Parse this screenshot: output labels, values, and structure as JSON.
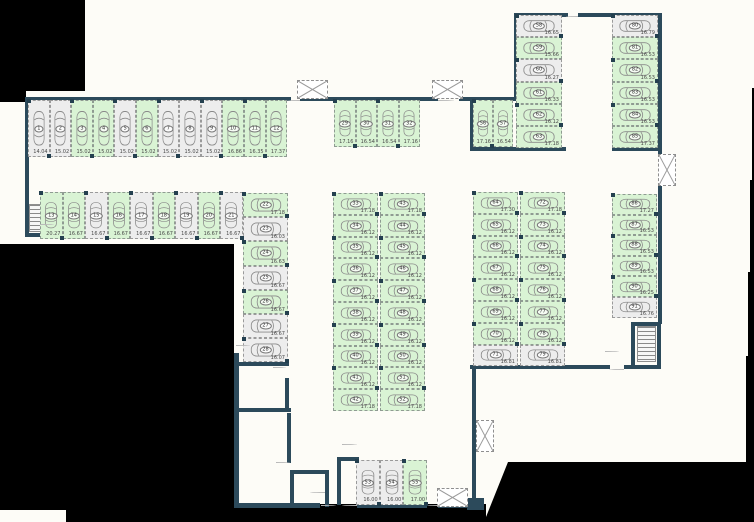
{
  "title": "parking-level-floor-plan",
  "colors": {
    "wall": "#2c4a5b",
    "stall_available": "#d9f3d4",
    "stall_unavailable": "#ededed",
    "background": "#fdfcf7",
    "dashed_line": "#8f9b92",
    "masked": "#000000"
  },
  "groups": [
    {
      "name": "row-top",
      "orient": "v",
      "x": 28,
      "y": 100,
      "w": 21.6,
      "h": 57,
      "stalls": [
        {
          "n": "1",
          "m": "14.04",
          "a": false
        },
        {
          "n": "2",
          "m": "15.02",
          "a": false
        },
        {
          "n": "3",
          "m": "15.02",
          "a": true
        },
        {
          "n": "4",
          "m": "15.02",
          "a": true
        },
        {
          "n": "5",
          "m": "15.02",
          "a": false
        },
        {
          "n": "6",
          "m": "15.02",
          "a": true
        },
        {
          "n": "7",
          "m": "15.02",
          "a": false
        },
        {
          "n": "8",
          "m": "15.02",
          "a": false
        },
        {
          "n": "9",
          "m": "15.02",
          "a": false
        },
        {
          "n": "10",
          "m": "16.86",
          "a": true
        },
        {
          "n": "11",
          "m": "16.35",
          "a": true
        },
        {
          "n": "12",
          "m": "17.37",
          "a": true
        }
      ]
    },
    {
      "name": "row-second",
      "orient": "v",
      "x": 40,
      "y": 192,
      "w": 22.5,
      "h": 47,
      "stalls": [
        {
          "n": "13",
          "m": "20.27",
          "a": true
        },
        {
          "n": "14",
          "m": "16.67",
          "a": true
        },
        {
          "n": "15",
          "m": "16.67",
          "a": false
        },
        {
          "n": "16",
          "m": "16.67",
          "a": true
        },
        {
          "n": "17",
          "m": "16.67",
          "a": false
        },
        {
          "n": "18",
          "m": "16.67",
          "a": true
        },
        {
          "n": "19",
          "m": "16.67",
          "a": false
        },
        {
          "n": "20",
          "m": "16.67",
          "a": true
        },
        {
          "n": "21",
          "m": "16.67",
          "a": false
        }
      ]
    },
    {
      "name": "col-left",
      "orient": "h",
      "x": 243,
      "y": 193,
      "w": 45,
      "h": 24.2,
      "stalls": [
        {
          "n": "22",
          "m": "17.18",
          "a": true
        },
        {
          "n": "23",
          "m": "16.03",
          "a": false
        },
        {
          "n": "24",
          "m": "16.63",
          "a": true
        },
        {
          "n": "25",
          "m": "16.67",
          "a": false
        },
        {
          "n": "26",
          "m": "16.67",
          "a": true
        },
        {
          "n": "27",
          "m": "16.67",
          "a": false
        },
        {
          "n": "28",
          "m": "16.07",
          "a": false
        }
      ]
    },
    {
      "name": "mid-top-row",
      "orient": "v",
      "x": 334,
      "y": 100,
      "w": 21.5,
      "h": 47,
      "stalls": [
        {
          "n": "29",
          "m": "17.16",
          "a": true
        },
        {
          "n": "30",
          "m": "16.54",
          "a": true
        },
        {
          "n": "31",
          "m": "16.54",
          "a": true
        },
        {
          "n": "32",
          "m": "17.16",
          "a": true
        }
      ]
    },
    {
      "name": "mid-block-left",
      "orient": "h",
      "x": 333,
      "y": 193,
      "w": 45,
      "h": 21.8,
      "stalls": [
        {
          "n": "33",
          "m": "17.18",
          "a": true
        },
        {
          "n": "34",
          "m": "16.12",
          "a": true
        },
        {
          "n": "35",
          "m": "16.12",
          "a": true
        },
        {
          "n": "36",
          "m": "16.12",
          "a": true
        },
        {
          "n": "37",
          "m": "16.12",
          "a": true
        },
        {
          "n": "38",
          "m": "16.12",
          "a": true
        },
        {
          "n": "39",
          "m": "16.12",
          "a": true
        },
        {
          "n": "40",
          "m": "16.12",
          "a": true
        },
        {
          "n": "41",
          "m": "16.12",
          "a": true
        },
        {
          "n": "42",
          "m": "17.18",
          "a": true
        }
      ]
    },
    {
      "name": "mid-block-right",
      "orient": "h",
      "x": 380,
      "y": 193,
      "w": 45,
      "h": 21.8,
      "stalls": [
        {
          "n": "43",
          "m": "17.18",
          "a": true
        },
        {
          "n": "44",
          "m": "16.12",
          "a": true
        },
        {
          "n": "45",
          "m": "16.12",
          "a": true
        },
        {
          "n": "46",
          "m": "16.12",
          "a": true
        },
        {
          "n": "47",
          "m": "16.12",
          "a": true
        },
        {
          "n": "48",
          "m": "16.12",
          "a": true
        },
        {
          "n": "49",
          "m": "16.12",
          "a": true
        },
        {
          "n": "50",
          "m": "16.12",
          "a": true
        },
        {
          "n": "51",
          "m": "16.12",
          "a": true
        },
        {
          "n": "52",
          "m": "17.18",
          "a": true
        }
      ]
    },
    {
      "name": "bottom-row",
      "orient": "v",
      "x": 356,
      "y": 460,
      "w": 23.7,
      "h": 45,
      "stalls": [
        {
          "n": "53",
          "m": "16.00",
          "a": false
        },
        {
          "n": "54",
          "m": "16.00",
          "a": false
        },
        {
          "n": "55",
          "m": "17.00",
          "a": true
        }
      ]
    },
    {
      "name": "topright-vertical-pair",
      "orient": "v",
      "x": 473,
      "y": 100,
      "w": 20,
      "h": 47,
      "stalls": [
        {
          "n": "56",
          "m": "17.16",
          "a": true
        },
        {
          "n": "57",
          "m": "16.54",
          "a": true
        }
      ]
    },
    {
      "name": "topright-col-left",
      "orient": "h",
      "x": 516,
      "y": 15,
      "w": 46,
      "h": 22.2,
      "stalls": [
        {
          "n": "58",
          "m": "16.65",
          "a": false
        },
        {
          "n": "59",
          "m": "15.66",
          "a": true
        },
        {
          "n": "60",
          "m": "16.27",
          "a": false
        },
        {
          "n": "61",
          "m": "16.33",
          "a": true
        },
        {
          "n": "62",
          "m": "16.12",
          "a": true
        },
        {
          "n": "63",
          "m": "17.18",
          "a": true
        }
      ]
    },
    {
      "name": "right-block-left",
      "orient": "h",
      "x": 473,
      "y": 192,
      "w": 45,
      "h": 21.8,
      "stalls": [
        {
          "n": "64",
          "m": "17.30",
          "a": true
        },
        {
          "n": "65",
          "m": "16.12",
          "a": true
        },
        {
          "n": "66",
          "m": "16.12",
          "a": true
        },
        {
          "n": "67",
          "m": "16.12",
          "a": true
        },
        {
          "n": "68",
          "m": "16.12",
          "a": true
        },
        {
          "n": "69",
          "m": "16.12",
          "a": true
        },
        {
          "n": "70",
          "m": "16.12",
          "a": true
        },
        {
          "n": "71",
          "m": "16.81",
          "a": false
        }
      ]
    },
    {
      "name": "right-block-right",
      "orient": "h",
      "x": 520,
      "y": 192,
      "w": 45,
      "h": 21.8,
      "stalls": [
        {
          "n": "72",
          "m": "17.18",
          "a": true
        },
        {
          "n": "73",
          "m": "16.12",
          "a": true
        },
        {
          "n": "74",
          "m": "16.12",
          "a": true
        },
        {
          "n": "75",
          "m": "16.12",
          "a": true
        },
        {
          "n": "76",
          "m": "16.12",
          "a": true
        },
        {
          "n": "77",
          "m": "16.12",
          "a": true
        },
        {
          "n": "78",
          "m": "16.12",
          "a": true
        },
        {
          "n": "79",
          "m": "16.81",
          "a": false
        }
      ]
    },
    {
      "name": "topright-col-right",
      "orient": "h",
      "x": 612,
      "y": 15,
      "w": 46,
      "h": 22.2,
      "stalls": [
        {
          "n": "80",
          "m": "16.79",
          "a": false
        },
        {
          "n": "81",
          "m": "16.53",
          "a": true
        },
        {
          "n": "82",
          "m": "16.53",
          "a": true
        },
        {
          "n": "83",
          "m": "16.53",
          "a": true
        },
        {
          "n": "84",
          "m": "16.53",
          "a": true
        },
        {
          "n": "85",
          "m": "17.37",
          "a": true
        }
      ]
    },
    {
      "name": "right-col",
      "orient": "h",
      "x": 612,
      "y": 194,
      "w": 45,
      "h": 20.6,
      "stalls": [
        {
          "n": "86",
          "m": "17.27",
          "a": true
        },
        {
          "n": "87",
          "m": "16.53",
          "a": true
        },
        {
          "n": "88",
          "m": "16.53",
          "a": true
        },
        {
          "n": "89",
          "m": "16.53",
          "a": true
        },
        {
          "n": "90",
          "m": "16.25",
          "a": true
        },
        {
          "n": "91",
          "m": "16.76",
          "a": false
        }
      ]
    }
  ],
  "walls": [
    [
      25,
      97,
      266,
      4
    ],
    [
      300,
      97,
      138,
      4
    ],
    [
      459,
      97,
      13,
      4
    ],
    [
      25,
      97,
      4,
      140
    ],
    [
      25,
      233,
      16,
      4
    ],
    [
      470,
      97,
      4,
      54
    ],
    [
      470,
      97,
      48,
      4
    ],
    [
      514,
      13,
      4,
      88
    ],
    [
      514,
      13,
      54,
      4
    ],
    [
      578,
      13,
      84,
      4
    ],
    [
      658,
      13,
      4,
      142
    ],
    [
      470,
      147,
      96,
      4
    ],
    [
      612,
      147,
      50,
      4
    ],
    [
      658,
      185,
      4,
      139
    ],
    [
      631,
      322,
      4,
      46
    ],
    [
      657,
      322,
      4,
      46
    ],
    [
      631,
      322,
      30,
      4
    ],
    [
      470,
      365,
      140,
      4
    ],
    [
      624,
      365,
      37,
      4
    ],
    [
      472,
      369,
      4,
      133
    ],
    [
      467,
      498,
      17,
      12
    ],
    [
      234,
      503,
      86,
      5
    ],
    [
      357,
      503,
      70,
      5
    ],
    [
      438,
      503,
      34,
      5
    ],
    [
      234,
      353,
      5,
      155
    ],
    [
      239,
      362,
      50,
      4
    ],
    [
      239,
      408,
      52,
      4
    ],
    [
      285,
      378,
      4,
      32
    ],
    [
      287,
      413,
      4,
      50
    ],
    [
      290,
      470,
      39,
      4
    ],
    [
      290,
      470,
      4,
      37
    ],
    [
      325,
      470,
      4,
      37
    ],
    [
      337,
      461,
      4,
      44
    ],
    [
      337,
      457,
      22,
      4
    ]
  ],
  "black_regions": [
    {
      "r": [
        0,
        0,
        85,
        91
      ]
    },
    {
      "r": [
        0,
        91,
        26,
        11
      ]
    },
    {
      "r": [
        0,
        244,
        234,
        266
      ]
    },
    {
      "r": [
        66,
        504,
        420,
        18
      ]
    },
    {
      "r": [
        484,
        462,
        270,
        60
      ],
      "clip": "polygon(24px 0px, 270px 0px, 270px 60px, 0px 60px)"
    },
    {
      "r": [
        752,
        88,
        2,
        92
      ]
    },
    {
      "r": [
        750,
        180,
        4,
        92
      ]
    },
    {
      "r": [
        748,
        272,
        6,
        84
      ]
    },
    {
      "r": [
        746,
        356,
        8,
        108
      ]
    }
  ],
  "shafts": [
    [
      297,
      80,
      31,
      19
    ],
    [
      432,
      80,
      31,
      19
    ],
    [
      658,
      154,
      18,
      32
    ],
    [
      476,
      420,
      18,
      32
    ],
    [
      437,
      488,
      31,
      19
    ]
  ],
  "stairs": [
    [
      29,
      204,
      12,
      28
    ],
    [
      637,
      326,
      19,
      36
    ]
  ],
  "door_arcs": [
    {
      "r": [
        287,
        100,
        13
      ],
      "q": "bl"
    },
    {
      "r": [
        438,
        100,
        16
      ],
      "q": "br"
    },
    {
      "r": [
        566,
        16,
        12
      ],
      "q": "bl"
    },
    {
      "r": [
        40,
        224,
        14
      ],
      "q": "tr"
    },
    {
      "r": [
        236,
        345,
        14
      ],
      "q": "br"
    },
    {
      "r": [
        273,
        367,
        13
      ],
      "q": "br"
    },
    {
      "r": [
        276,
        462,
        14
      ],
      "q": "br"
    },
    {
      "r": [
        310,
        492,
        15
      ],
      "q": "tl"
    },
    {
      "r": [
        321,
        505,
        15
      ],
      "q": "tr"
    },
    {
      "r": [
        342,
        505,
        15
      ],
      "q": "tl"
    },
    {
      "r": [
        427,
        505,
        12
      ],
      "q": "tl"
    },
    {
      "r": [
        605,
        351,
        14
      ],
      "q": "tr"
    },
    {
      "r": [
        609,
        369,
        15
      ],
      "q": "bl"
    },
    {
      "r": [
        342,
        444,
        15
      ],
      "q": "br"
    }
  ]
}
